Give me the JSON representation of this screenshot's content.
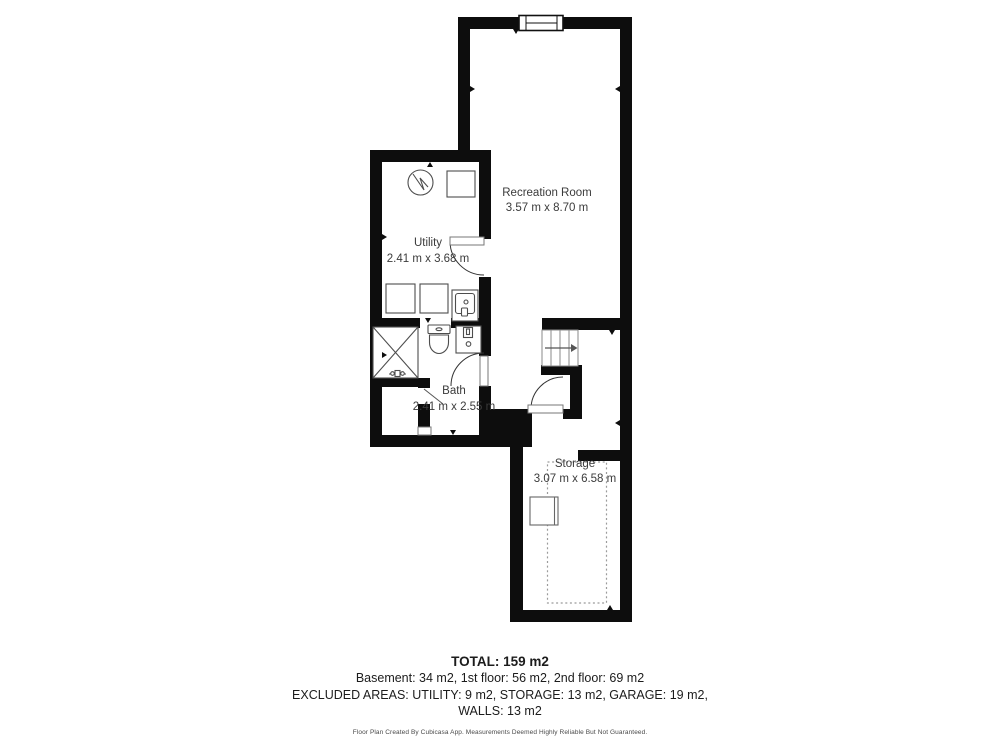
{
  "plan": {
    "wall_color": "#0d0d0d",
    "label_color": "#3b3b3b",
    "rooms": [
      {
        "name": "Recreation Room",
        "dims": "3.57 m x 8.70 m"
      },
      {
        "name": "Utility",
        "dims": "2.41 m x 3.68 m"
      },
      {
        "name": "Bath",
        "dims": "2.41 m x 2.55 m"
      },
      {
        "name": "Storage",
        "dims": "3.07 m x 6.58 m"
      }
    ]
  },
  "summary": {
    "total": "TOTAL: 159 m2",
    "floors": "Basement: 34 m2, 1st floor: 56 m2, 2nd floor: 69 m2",
    "excluded": "EXCLUDED AREAS: UTILITY: 9 m2, STORAGE: 13 m2, GARAGE: 19 m2,",
    "walls": "WALLS: 13 m2",
    "disclaimer": "Floor Plan Created By Cubicasa App. Measurements Deemed Highly Reliable But Not Guaranteed."
  }
}
